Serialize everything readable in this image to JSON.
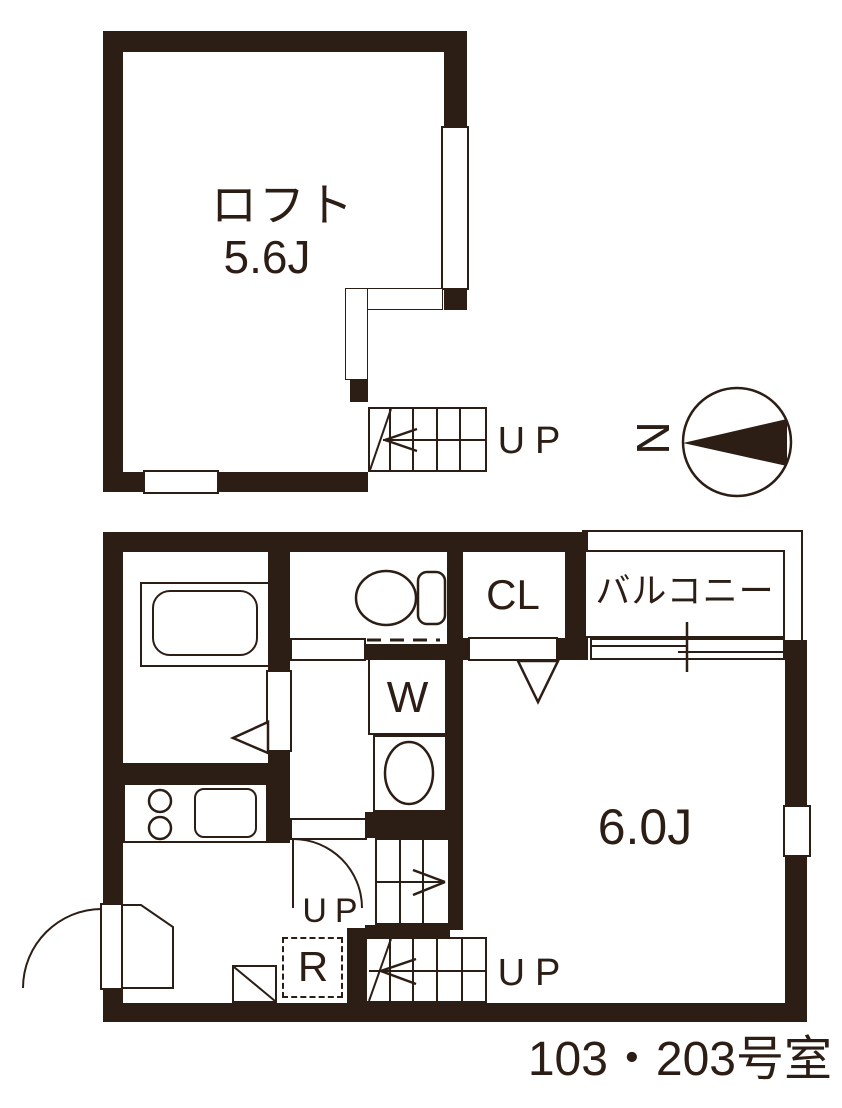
{
  "title": "103・203号室",
  "colors": {
    "wall": "#2c1d15",
    "background": "#ffffff"
  },
  "compass": {
    "north_label": "N",
    "direction": "north-points-left"
  },
  "loft": {
    "room_label": "ロフト",
    "size_label": "5.6J",
    "stairs_up_label": "UP"
  },
  "main_floor": {
    "room_size_label": "6.0J",
    "closet_label": "CL",
    "balcony_label": "バルコニー",
    "washing_machine_label": "W",
    "refrigerator_label": "R",
    "stairs_up_label": "UP",
    "hall_up_label": "UP"
  }
}
